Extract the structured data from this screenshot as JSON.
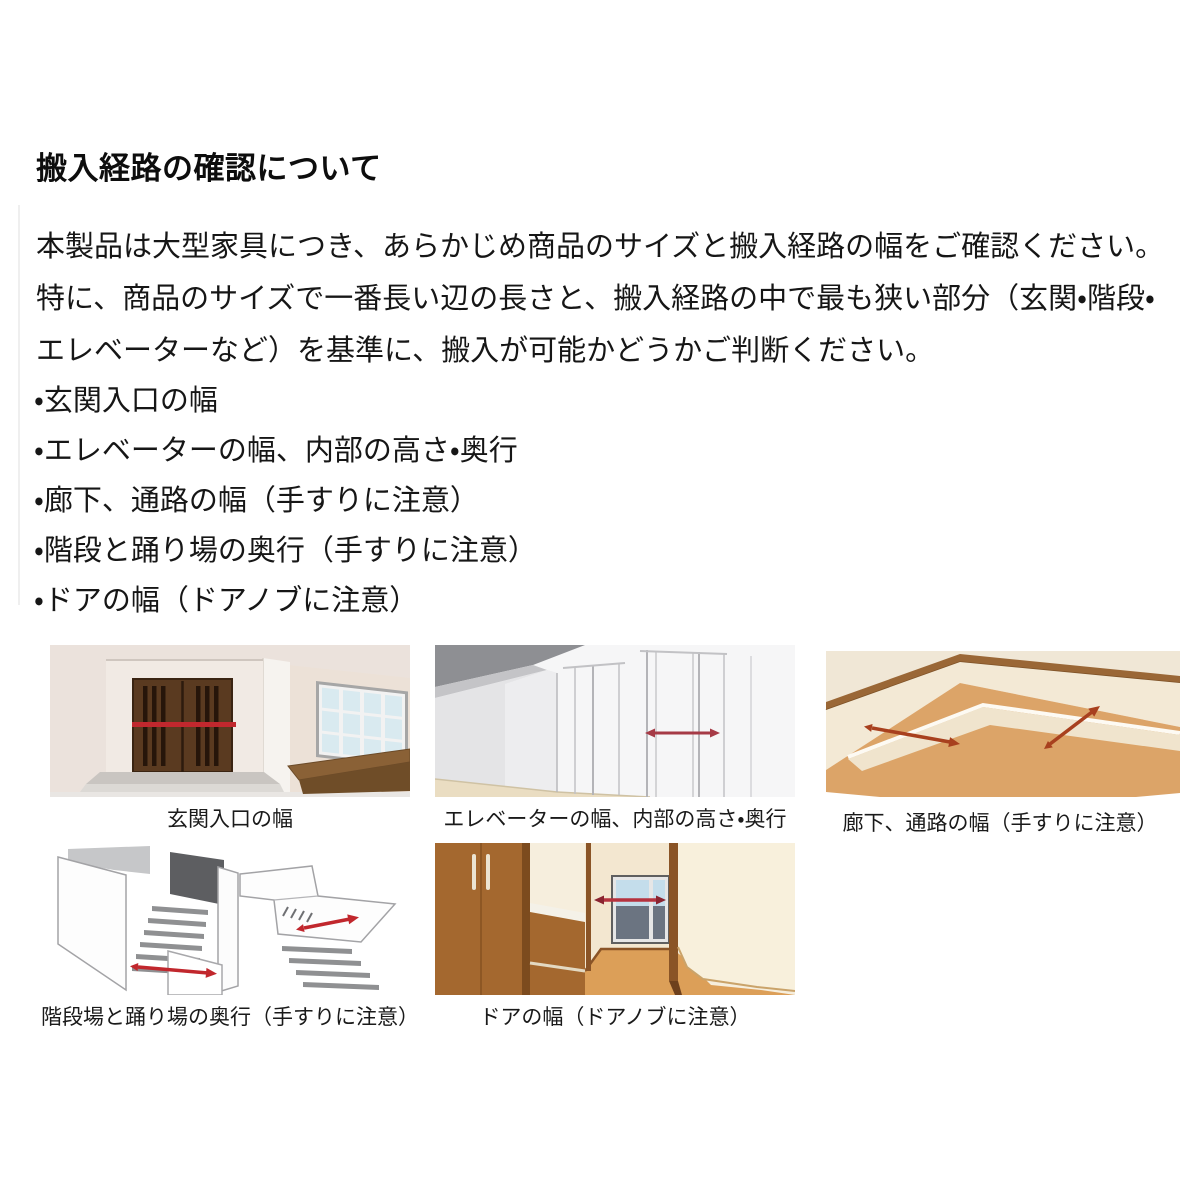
{
  "document": {
    "title": "搬入経路の確認について",
    "intro": {
      "lines": [
        "本製品は大型家具につき、あらかじめ商品のサイズと搬入経路の幅をご確認ください。",
        "特に、商品のサイズで一番長い辺の長さと、搬入経路の中で最も狭い部分（玄関・階段・",
        "エレベーターなど）を基準に、搬入が可能かどうかご判断ください。"
      ]
    },
    "checklist": [
      "・玄関入口の幅",
      "・エレベーターの幅、内部の高さ・奥行",
      "・廊下、通路の幅（手すりに注意）",
      "・階段と踊り場の奥行（手すりに注意）",
      "・ドアの幅（ドアノブに注意）"
    ],
    "figures": [
      {
        "id": "entrance",
        "caption": "玄関入口の幅",
        "illustration": "entrance-double-door-with-width-arrow"
      },
      {
        "id": "elevator",
        "caption": "エレベーターの幅、内部の高さ・奥行",
        "illustration": "elevator-hall-doors-with-width-arrow"
      },
      {
        "id": "corridor",
        "caption": "廊下、通路の幅（手すりに注意）",
        "illustration": "l-shaped-corridor-with-width-arrows"
      },
      {
        "id": "stairs",
        "caption": "階段場と踊り場の奥行（手すりに注意）",
        "illustration": "staircase-and-landing-with-depth-arrows"
      },
      {
        "id": "door",
        "caption": "ドアの幅（ドアノブに注意）",
        "illustration": "hallway-door-with-width-arrow"
      }
    ],
    "palette": {
      "page_background": "#ffffff",
      "text": "#141414",
      "measure_arrow_red": "#c1272d",
      "door_wood_brown": "#5a3a20",
      "floor_tan": "#dca468",
      "handrail_brown": "#9a6736",
      "step_gray": "#8f9092",
      "wall_cream": "#f1e7d6"
    }
  }
}
